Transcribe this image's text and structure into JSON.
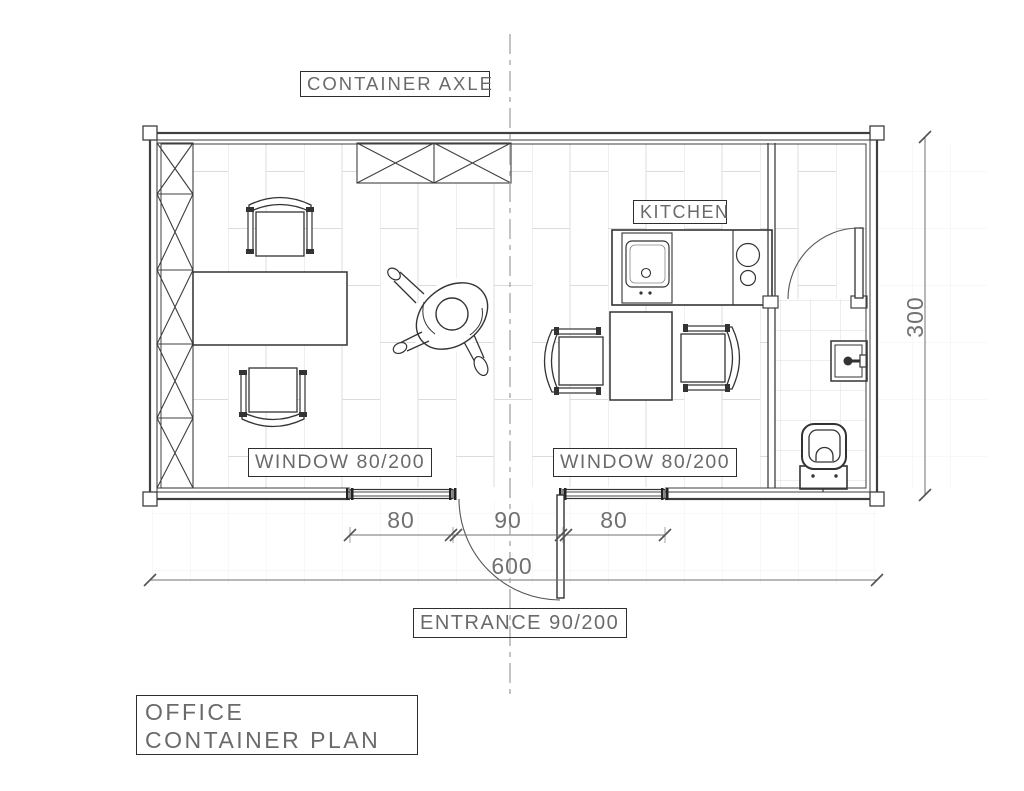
{
  "drawing": {
    "axle_label": "CONTAINER AXLE",
    "kitchen_label": "KITCHEN",
    "window_left_label": "WINDOW 80/200",
    "window_right_label": "WINDOW 80/200",
    "entrance_label": "ENTRANCE 90/200",
    "title": "OFFICE CONTAINER PLAN",
    "dims": {
      "seg_left": "80",
      "seg_mid": "90",
      "seg_right": "80",
      "total_width": "600",
      "total_height": "300"
    },
    "furniture": [
      "wardrobe-x-strip",
      "storage-x-cabinet",
      "desk",
      "office-chair",
      "meeting-table",
      "kitchen-counter",
      "kitchen-sink",
      "cooktop-burners",
      "wash-basin",
      "toilet",
      "person-top-view",
      "entrance-door",
      "bathroom-door"
    ],
    "colors": {
      "wall_line": "#3f3f3f",
      "furniture_line": "#333333",
      "floor_line": "#dcdcdc",
      "dimension": "#707070",
      "axle_line": "#a3a3a3",
      "background": "#ffffff"
    }
  }
}
